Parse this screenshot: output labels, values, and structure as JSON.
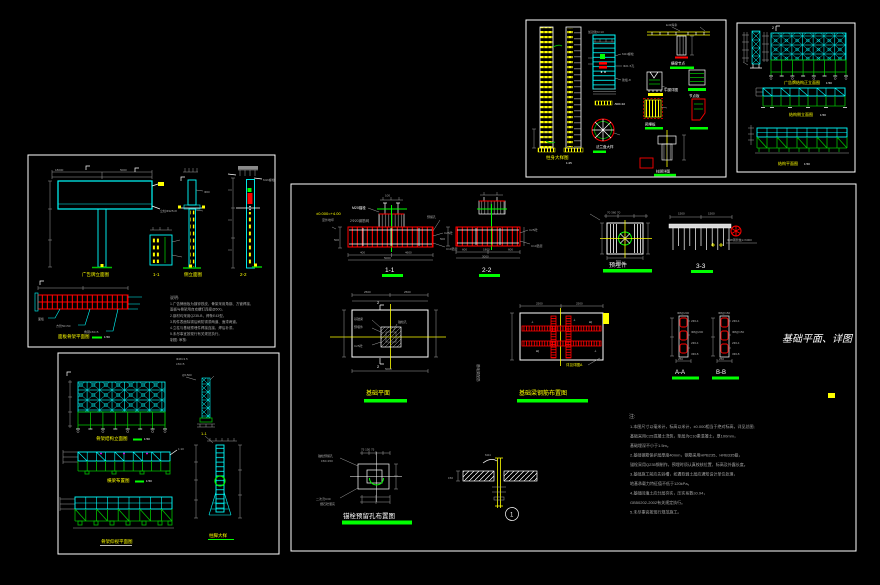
{
  "colors": {
    "background": "#000000",
    "cyan": "#00ffff",
    "yellow": "#ffff00",
    "red": "#ff0000",
    "bright_green": "#00ff00",
    "structure_green": "#00c000",
    "gray": "#a8a8a8",
    "white": "#ffffff",
    "magenta": "#ff00ff"
  },
  "p1": {
    "labels": {
      "column": "柱身大样图",
      "column_scale": "1:25",
      "flange": "法兰盘大样",
      "beam_node": "横梁节点",
      "bracket": "牛腿详图",
      "gusset": "节点板",
      "plate": "预埋板",
      "base": "柱脚详图"
    },
    "ann": {
      "a0": "加劲肋δ=10",
      "a1": "M24螺栓",
      "a2": "Φ21.5孔",
      "a3": "肋板-8",
      "a4": "-500×10",
      "a5": "E43焊条"
    }
  },
  "p2": {
    "labels": {
      "fig1": "广告牌结构正立面图",
      "fig1_scale": "1:50",
      "fig2": "结构侧立面图",
      "fig2_scale": "1:50",
      "fig3": "结构平面图",
      "fig3_scale": "1:50",
      "marker": "2"
    }
  },
  "p3": {
    "labels": {
      "fig1": "广告牌立面图",
      "fig2": "1-1",
      "fig3": "侧立面图",
      "fig4": "2-2",
      "panel": "面板骨架平面图",
      "panel_scale": "1:50"
    },
    "notes_title": "说明:",
    "notes": {
      "n0": "1.广告牌面板为镀锌铁皮，骨架采用角钢、方管焊接，",
      "n1": "  面板与骨架用自攻螺钉连接@500。",
      "n2": "2.钢材均采用Q235-B，焊条E43型。",
      "n3": "3.构件表面除锈后刷防锈漆两道、面漆两道。",
      "n4": "4.立柱与基础预埋件焊接连接，焊后补漆。",
      "n5": "5.未尽事宜按现行有关规范执行。",
      "n6": "  制图:  审核:"
    },
    "ann": {
      "a0": "18000",
      "a1": "5000",
      "a2": "面板",
      "a3": "方管50×50",
      "a4": "角钢L50×5",
      "a5": "立柱Φ325×8",
      "a6": "Φ60",
      "a7": "M16螺栓"
    }
  },
  "p4": {
    "labels": {
      "fig1": "骨架结构立面图",
      "fig1_scale": "1:50",
      "fig2": "1-1",
      "fig3": "横梁布置图",
      "fig3_scale": "1:50",
      "fig4": "骨架仰视平面图",
      "col": "柱脚大样"
    },
    "ann": {
      "a0": "Φ48×3.5",
      "a1": "L50×5",
      "a2": "@1500",
      "a3": "1:10"
    }
  },
  "p5": {
    "sections": {
      "s11": "1-1",
      "s22": "2-2",
      "s33": "3-3",
      "saa": "A-A",
      "sbb": "B-B"
    },
    "labels": {
      "embed": "预埋件",
      "plan": "基础平面",
      "rebar": "基础梁钢筋布置图",
      "anchor": "锚栓预留孔布置图",
      "callout": "1"
    },
    "title": "基础平面、详图",
    "texts": {
      "elev": "±0.000=+4.00",
      "ground": "室外地坪",
      "m20": "M20锚栓",
      "mesh": "2Φ20钢筋网",
      "hole": "预留孔",
      "c25": "C25砼",
      "cushion": "C10垫层",
      "pile": "Φ48钢管桩L=6000",
      "vertical": "基础梁配筋",
      "ref": "详见详图A",
      "weld": "M24",
      "ped": "100"
    },
    "dims": {
      "d400": "400",
      "d4600": "4600",
      "d5000": "5000",
      "d500": "500",
      "d600": "600",
      "d1800": "1800",
      "d3000": "3000",
      "d2500a": "2500",
      "d2500b": "2500",
      "d1500a": "1500",
      "d1500b": "1500",
      "d250": "250",
      "d70": "70 360 70",
      "d150": "150",
      "dcomb": "75 150 75",
      "marker": "2",
      "dsq": "500"
    },
    "plan_ann": {
      "a1": "基础梁",
      "a2": "预埋件",
      "a3": "C25砼",
      "a4": "锚栓孔"
    },
    "anchor_ann": {
      "a1": "锚栓预留孔",
      "a2": "150×150",
      "a3": "二次浇C30",
      "a4": "细石砼灌实"
    },
    "aa": {
      "top": "Φ8@200",
      "r0": "2Φ14",
      "r1": "Φ8@200",
      "r2": "2Φ14",
      "r3": "3Φ18"
    },
    "bb": {
      "top": "Φ8@150",
      "r0": "2Φ14",
      "r1": "Φ8@150",
      "r2": "2Φ14",
      "r3": "3Φ18"
    },
    "notes_title": "注:",
    "notes": {
      "n0": "1.本图尺寸以毫米计，标高以米计，±0.000相当于绝对标高，详见总图;",
      "n1": "  基础采用C25混凝土浇筑，垫层为C10素混凝土，厚100mm，",
      "n2": "  基础埋深不小于1.5m。",
      "n3": "2.基础钢筋保护层厚度40mm，钢筋采用HPB235、HRB335级，",
      "n4": "  锚栓采用Q235钢制作，预埋时须认真校核位置、标高及外露长度。",
      "n5": "3.基础施工前应先验槽，如遇软弱土层应通知设计单位处理，",
      "n6": "  地基承载力特征值不低于120kPa。",
      "n7": "4.基础回填土应分层夯实，压实系数≥0.94，",
      "n8": "  GB50202-2002有关规定执行。",
      "n9": "5.未尽事宜按现行规范施工。"
    }
  }
}
